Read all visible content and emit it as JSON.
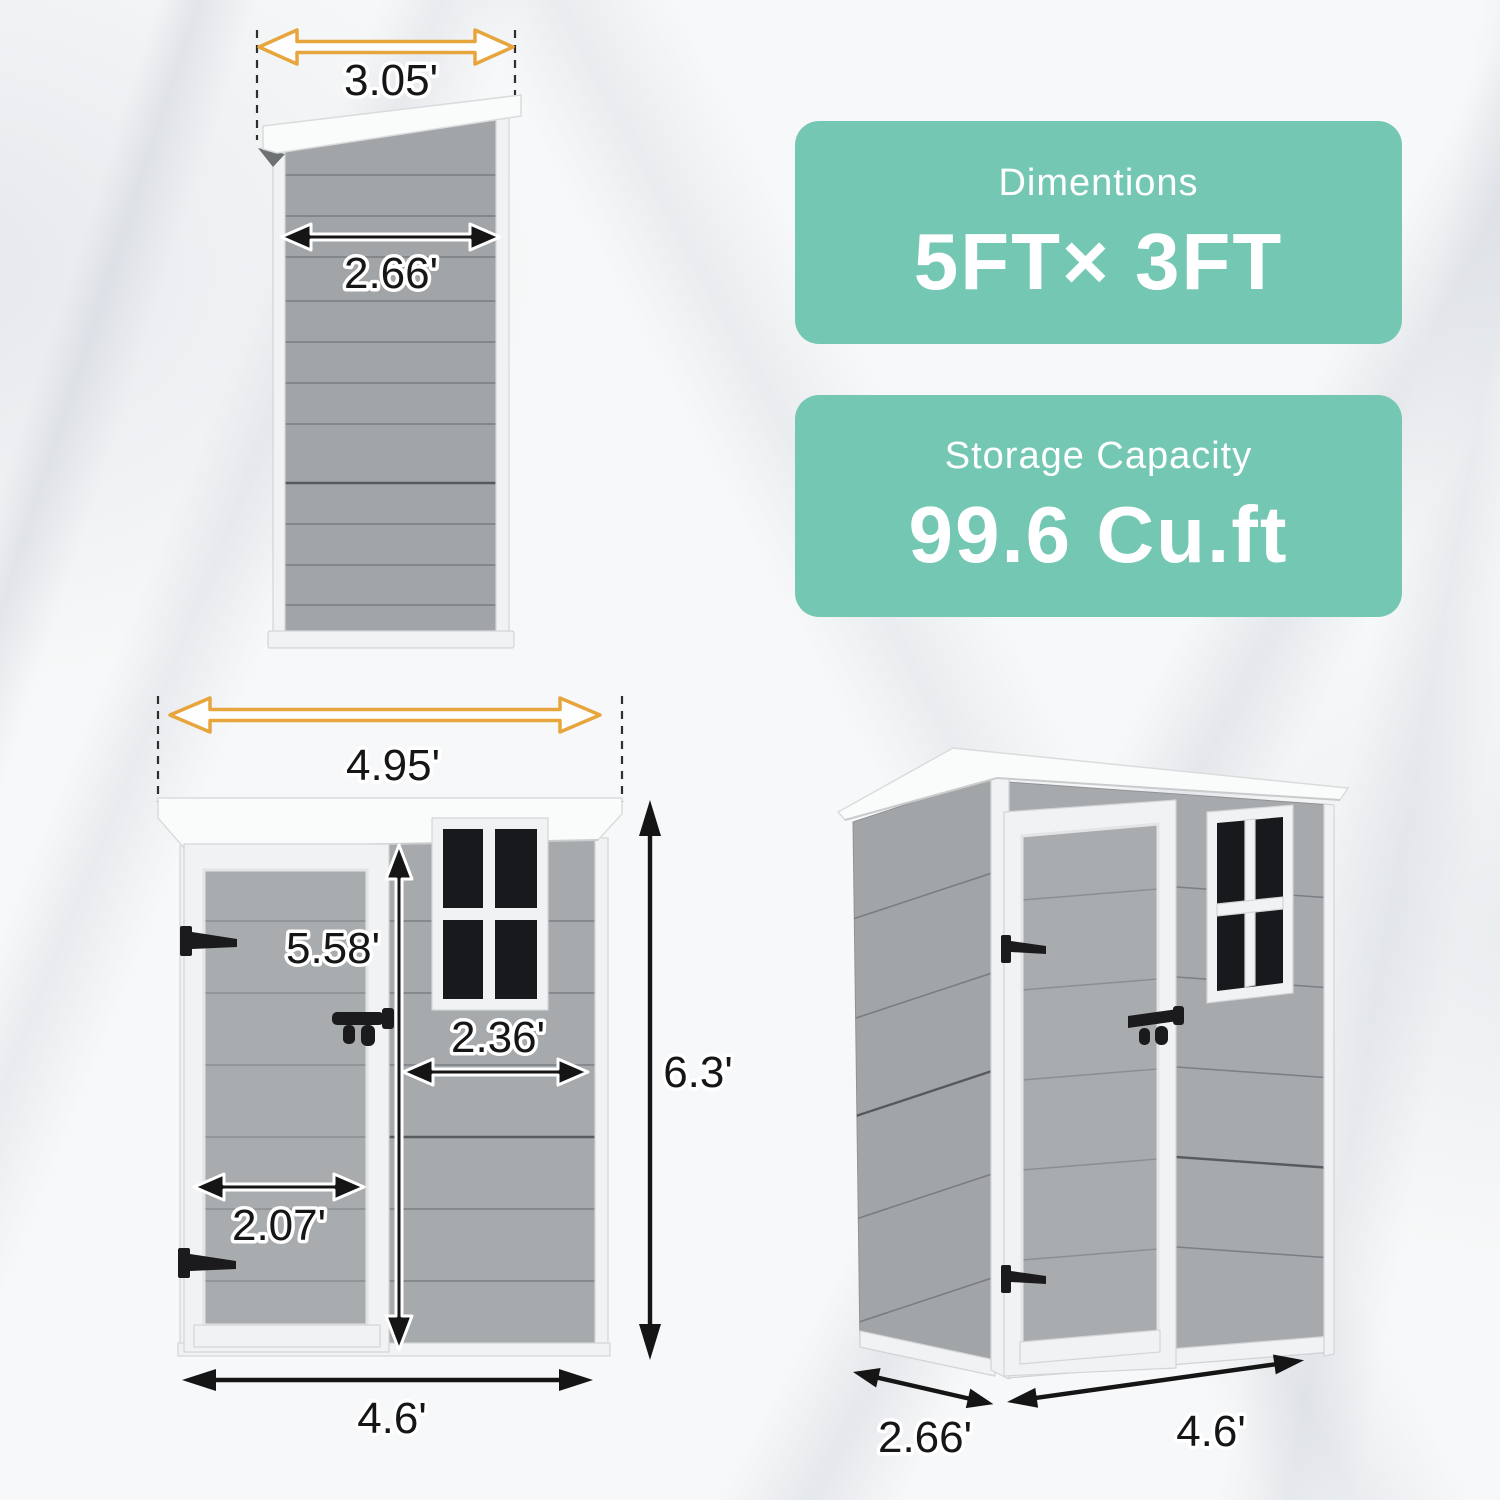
{
  "badges": {
    "dimensions": {
      "title": "Dimentions",
      "value": "5FT× 3FT"
    },
    "capacity": {
      "title": "Storage Capacity",
      "value": "99.6 Cu.ft"
    }
  },
  "side_view": {
    "labels": {
      "roof_width": "3.05'",
      "wall_width": "2.66'"
    }
  },
  "front_view": {
    "labels": {
      "roof_width": "4.95'",
      "door_height": "5.58'",
      "window_width": "2.36'",
      "door_width": "2.07'",
      "base_width": "4.6'",
      "total_height": "6.3'"
    }
  },
  "perspective_view": {
    "labels": {
      "depth": "2.66'",
      "width": "4.6'"
    }
  },
  "colors": {
    "badge_teal": "#74c8b3",
    "arrow_yellow": "#e7a53d",
    "dimension_black": "#151515",
    "wall_gray": "#a7aaad",
    "trim_white": "#f0f2f3",
    "window_pane": "#17191c"
  }
}
